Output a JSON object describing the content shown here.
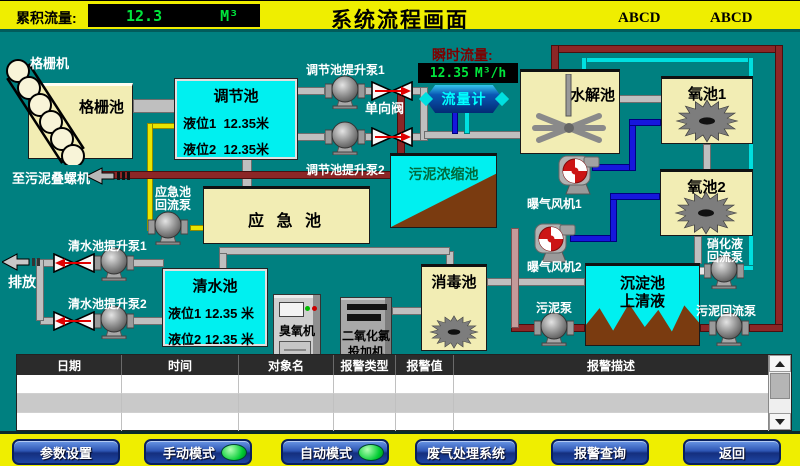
{
  "header": {
    "cumulative_flow_label": "累积流量:",
    "cumulative_flow_value": "12.3",
    "cumulative_flow_unit": "M³",
    "title": "系统流程画面",
    "badge_left": "ABCD",
    "badge_right": "ABCD"
  },
  "diagram": {
    "grid_machine_label": "格栅机",
    "grid_pool_label": "格栅池",
    "regulation_pool": {
      "title": "调节池",
      "level1": "液位1  12.35米",
      "level2": "液位2  12.35米"
    },
    "regulation_pump1_label": "调节池提升泵1",
    "regulation_pump2_label": "调节池提升泵2",
    "check_valve_label": "单向阀",
    "instant_flow_label": "瞬时流量:",
    "instant_flow_value": "12.35",
    "instant_flow_unit": "M³/h",
    "flow_meter_label": "流量计",
    "hydrolysis_pool_label": "水解池",
    "oxygen_pool1_label": "氧池1",
    "oxygen_pool2_label": "氧池2",
    "sludge_thickener_label": "污泥浓缩池",
    "emergency_pool_label": "应 急 池",
    "emergency_return_pump_line1": "应急池",
    "emergency_return_pump_line2": "回流泵",
    "to_sludge_screw_label": "至污泥叠螺机",
    "clear_pump1_label": "清水池提升泵1",
    "clear_pump2_label": "清水池提升泵2",
    "discharge_label": "排放",
    "clear_pool": {
      "title": "清水池",
      "level1": "液位1 12.35 米",
      "level2": "液位2 12.35 米"
    },
    "ozone_machine_label": "臭氧机",
    "chlorine_doser_line1": "二氧化氯",
    "chlorine_doser_line2": "投加机",
    "disinfection_pool_label": "消毒池",
    "aeration_fan1_label": "曝气风机1",
    "aeration_fan2_label": "曝气风机2",
    "sedimentation_line1": "沉淀池",
    "sedimentation_line2": "上清液",
    "sludge_pump_label": "污泥泵",
    "nitration_return_line1": "硝化液",
    "nitration_return_line2": "回流泵",
    "sludge_return_pump_label": "污泥回流泵"
  },
  "alarm_table": {
    "columns": [
      "日期",
      "时间",
      "对象名",
      "报警类型",
      "报警值",
      "报警描述"
    ],
    "rows": [
      [
        "",
        "",
        "",
        "",
        "",
        ""
      ],
      [
        "",
        "",
        "",
        "",
        "",
        ""
      ],
      [
        "",
        "",
        "",
        "",
        "",
        ""
      ]
    ]
  },
  "footer": {
    "buttons": [
      {
        "label": "参数设置",
        "indicator": false
      },
      {
        "label": "手动模式",
        "indicator": true
      },
      {
        "label": "自动模式",
        "indicator": true
      },
      {
        "label": "废气处理系统",
        "indicator": false
      },
      {
        "label": "报警查询",
        "indicator": false
      },
      {
        "label": "返回",
        "indicator": false
      }
    ]
  },
  "colors": {
    "background_teal": "#008080",
    "bar_yellow": "#efee00",
    "lcd_text_green": "#00e53c",
    "instant_flow_label_red": "#7d0000",
    "tank_cream": "#f2edb4",
    "tank_cyan": "#00f0f0",
    "indicator_green": "#00cc33"
  }
}
